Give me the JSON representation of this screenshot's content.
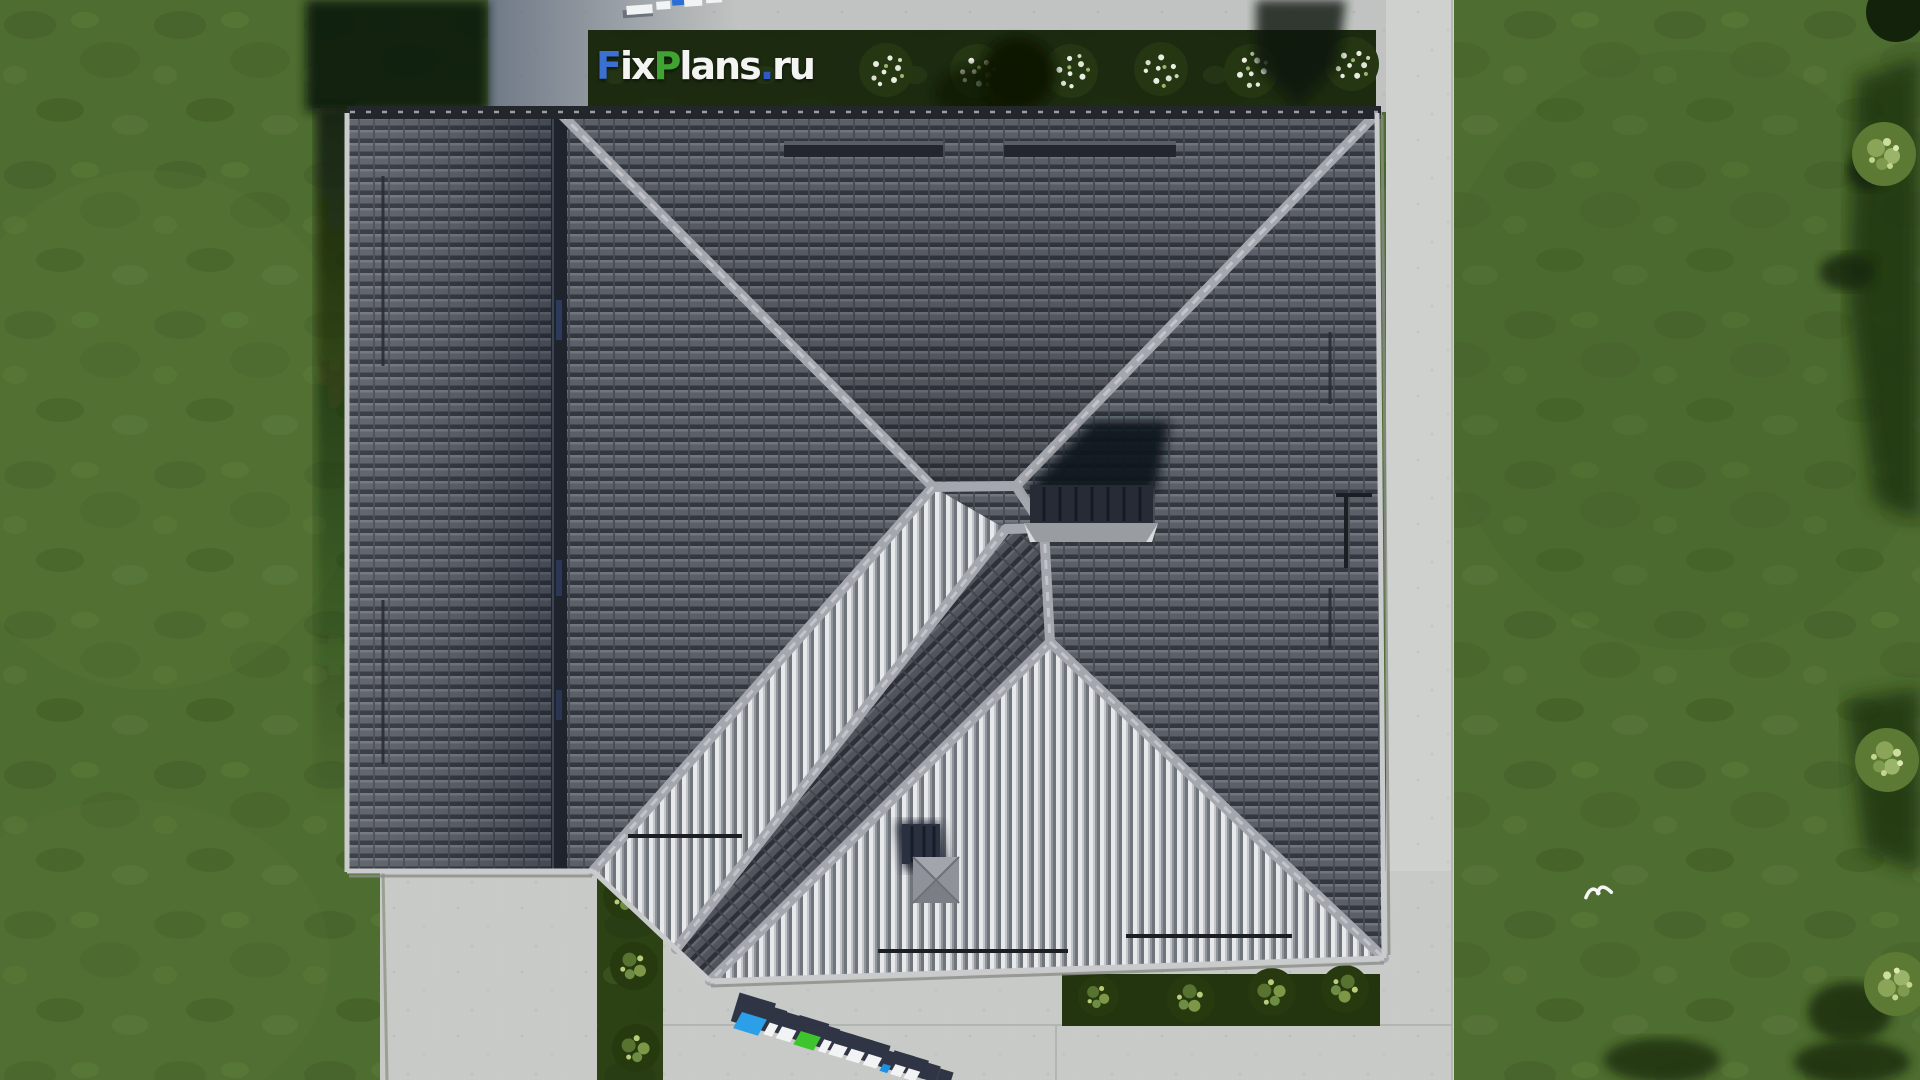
{
  "brand": {
    "full": "FixPlans.ru",
    "segments": [
      {
        "text": "F",
        "color": "#3b6fd2"
      },
      {
        "text": "ix",
        "color": "#f4f4f2"
      },
      {
        "text": "P",
        "color": "#41a432"
      },
      {
        "text": "lans",
        "color": "#f4f4f2"
      },
      {
        "text": ".",
        "color": "#2e59c8"
      },
      {
        "text": "ru",
        "color": "#f4f4f2"
      }
    ]
  },
  "watermark_top": {
    "text": "FixPlans.ru"
  },
  "watermark_bottom": {
    "text": "FixPlans.ru"
  },
  "colors": {
    "lawn": "#4e6d30",
    "lawn_shadow": "#0d1b09",
    "concrete": "#c8cac7",
    "concrete_top": "#c0c3c1",
    "concrete_right": "#cfd1ce",
    "hedge": "#1c2b10",
    "garden_bed": "#23350f",
    "roof_base": "#5b5f67",
    "roof_row": "#33373e",
    "rib_light": "#e7e9eb",
    "rib_base": "#9ca0a7",
    "ridge": "#a4a7ad",
    "fascia": "#c9cbcd",
    "chimney_body": "#262b36",
    "chimney_cap": "#999ca1",
    "cast_shadow": "#10141c",
    "wm_blue": "#2ba0e8",
    "wm_green": "#3ec52e",
    "wm_white": "#f2f3f4",
    "wm_dark": "#272e3e"
  }
}
